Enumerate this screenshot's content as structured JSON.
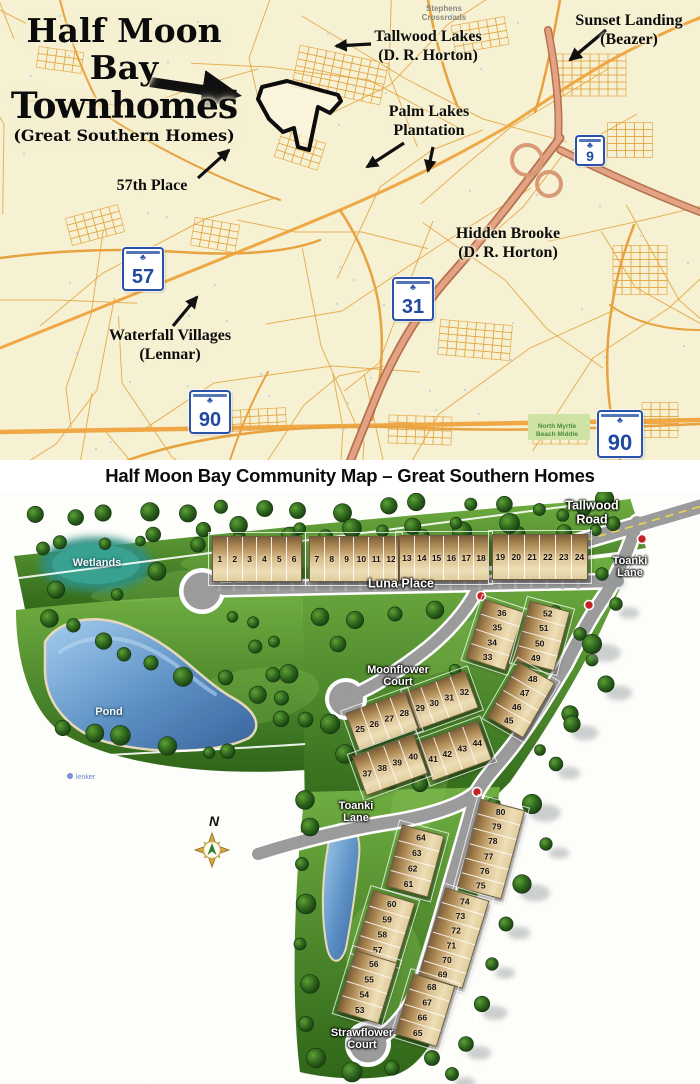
{
  "caption": "Half Moon Bay Community Map – Great Southern Homes",
  "locator_map": {
    "title": {
      "line1": "Half Moon",
      "line2": "Bay",
      "line3": "Townhomes",
      "subtitle": "(Great Southern Homes)"
    },
    "annotations": [
      {
        "name": "stephens-crossroads",
        "style": "tiny",
        "lines": [
          "Stephens",
          "Crossroads"
        ],
        "x": 444,
        "y": 4
      },
      {
        "name": "tallwood-lakes",
        "style": "callout",
        "lines": [
          "Tallwood Lakes",
          "(D. R. Horton)"
        ],
        "x": 428,
        "y": 27
      },
      {
        "name": "sunset-landing",
        "style": "callout",
        "lines": [
          "Sunset Landing",
          "(Beazer)"
        ],
        "x": 629,
        "y": 11
      },
      {
        "name": "palm-lakes-plantation",
        "style": "callout",
        "lines": [
          "Palm Lakes",
          "Plantation"
        ],
        "x": 429,
        "y": 102
      },
      {
        "name": "57th-place",
        "style": "callout",
        "lines": [
          "57th Place"
        ],
        "x": 152,
        "y": 176
      },
      {
        "name": "hidden-brooke",
        "style": "callout",
        "lines": [
          "Hidden Brooke",
          "(D. R. Horton)"
        ],
        "x": 508,
        "y": 224
      },
      {
        "name": "waterfall-villages",
        "style": "callout",
        "lines": [
          "Waterfall Villages",
          "(Lennar)"
        ],
        "x": 170,
        "y": 326
      },
      {
        "name": "north-myrtle-beach-middle-school",
        "style": "tiny-green",
        "lines": [
          "North Myrtle",
          "Beach Middle"
        ],
        "x": 557,
        "y": 423
      }
    ],
    "arrows": [
      {
        "name": "arrow-half-moon-bay",
        "x1": 150,
        "y1": 82,
        "x2": 236,
        "y2": 95,
        "w": 10
      },
      {
        "name": "arrow-tallwood-lakes",
        "x1": 371,
        "y1": 44,
        "x2": 336,
        "y2": 46,
        "w": 3.2
      },
      {
        "name": "arrow-sunset-landing",
        "x1": 606,
        "y1": 30,
        "x2": 570,
        "y2": 60,
        "w": 3.4
      },
      {
        "name": "arrow-palm-lakes-1",
        "x1": 404,
        "y1": 143,
        "x2": 367,
        "y2": 167,
        "w": 3.2
      },
      {
        "name": "arrow-palm-lakes-2",
        "x1": 433,
        "y1": 147,
        "x2": 428,
        "y2": 171,
        "w": 3.2
      },
      {
        "name": "arrow-57th-place",
        "x1": 198,
        "y1": 178,
        "x2": 229,
        "y2": 150,
        "w": 3.2
      },
      {
        "name": "arrow-waterfall-villages",
        "x1": 173,
        "y1": 326,
        "x2": 197,
        "y2": 297,
        "w": 3.2
      }
    ],
    "shields": [
      {
        "number": "9",
        "x": 575,
        "y": 135,
        "size": 26
      },
      {
        "number": "57",
        "x": 122,
        "y": 247,
        "size": 38
      },
      {
        "number": "31",
        "x": 392,
        "y": 277,
        "size": 38
      },
      {
        "number": "90",
        "x": 189,
        "y": 390,
        "size": 38
      },
      {
        "number": "90",
        "x": 597,
        "y": 410,
        "size": 42
      }
    ]
  },
  "site_plan": {
    "street_labels": [
      {
        "name": "tallwood-road",
        "size": "lg",
        "lines": [
          "Tallwood",
          "Road"
        ],
        "x": 592,
        "y": 21
      },
      {
        "name": "toanki-lane-upper",
        "size": "",
        "lines": [
          "Toanki",
          "Lane"
        ],
        "x": 630,
        "y": 75
      },
      {
        "name": "luna-place",
        "size": "lg",
        "lines": [
          "Luna Place"
        ],
        "x": 401,
        "y": 92
      },
      {
        "name": "moonflower-court",
        "size": "",
        "lines": [
          "Moonflower",
          "Court"
        ],
        "x": 398,
        "y": 184
      },
      {
        "name": "toanki-lane-lower",
        "size": "",
        "lines": [
          "Toanki",
          "Lane"
        ],
        "x": 356,
        "y": 320
      },
      {
        "name": "strawflower-court",
        "size": "",
        "lines": [
          "Strawflower",
          "Court"
        ],
        "x": 362,
        "y": 547
      }
    ],
    "area_labels": [
      {
        "name": "wetlands",
        "text": "Wetlands",
        "x": 97,
        "y": 71
      },
      {
        "name": "pond",
        "text": "Pond",
        "x": 109,
        "y": 220
      }
    ],
    "compass_label": "N",
    "watermark": "lenker",
    "buildings": [
      {
        "name": "lots-1-6",
        "type": "row",
        "display": [
          "1",
          "2",
          "3",
          "4",
          "5",
          "6"
        ],
        "cx": 256,
        "cy": 66,
        "w": 88,
        "h": 44,
        "rot": 0,
        "stubs": true
      },
      {
        "name": "lots-7-12",
        "type": "row",
        "display": [
          "7",
          "8",
          "9",
          "10",
          "11",
          "12"
        ],
        "cx": 353,
        "cy": 66,
        "w": 88,
        "h": 44,
        "rot": 0,
        "stubs": true
      },
      {
        "name": "lots-13-18",
        "type": "row",
        "display": [
          "13",
          "14",
          "15",
          "16",
          "17",
          "18"
        ],
        "cx": 443,
        "cy": 65,
        "w": 88,
        "h": 44,
        "rot": 0,
        "stubs": true
      },
      {
        "name": "lots-19-24",
        "type": "row",
        "display": [
          "19",
          "20",
          "21",
          "22",
          "23",
          "24"
        ],
        "cx": 539,
        "cy": 64,
        "w": 94,
        "h": 44,
        "rot": 0,
        "stubs": true
      },
      {
        "name": "lots-33-36",
        "type": "stack",
        "display": [
          "36",
          "35",
          "34",
          "33"
        ],
        "cx": 494,
        "cy": 142,
        "w": 40,
        "h": 60,
        "rot": 18,
        "stubs": false
      },
      {
        "name": "lots-49-52",
        "type": "stack",
        "display": [
          "52",
          "51",
          "50",
          "49"
        ],
        "cx": 541,
        "cy": 143,
        "w": 40,
        "h": 60,
        "rot": 15,
        "stubs": false
      },
      {
        "name": "lots-45-48",
        "type": "stack",
        "display": [
          "48",
          "47",
          "46",
          "45"
        ],
        "cx": 520,
        "cy": 207,
        "w": 40,
        "h": 62,
        "rot": 30,
        "stubs": false
      },
      {
        "name": "lots-29-32",
        "type": "row",
        "display": [
          "29",
          "30",
          "31",
          "32"
        ],
        "cx": 441,
        "cy": 207,
        "w": 62,
        "h": 38,
        "rot": -20,
        "stubs": false
      },
      {
        "name": "lots-25-28",
        "type": "row",
        "display": [
          "25",
          "26",
          "27",
          "28"
        ],
        "cx": 381,
        "cy": 228,
        "w": 62,
        "h": 38,
        "rot": -20,
        "stubs": false
      },
      {
        "name": "lots-41-44",
        "type": "row",
        "display": [
          "41",
          "42",
          "43",
          "44"
        ],
        "cx": 454,
        "cy": 258,
        "w": 62,
        "h": 40,
        "rot": -20,
        "stubs": false
      },
      {
        "name": "lots-37-40",
        "type": "row",
        "display": [
          "37",
          "38",
          "39",
          "40"
        ],
        "cx": 389,
        "cy": 272,
        "w": 64,
        "h": 40,
        "rot": -20,
        "stubs": false
      },
      {
        "name": "lots-61-64",
        "type": "stack",
        "display": [
          "64",
          "63",
          "62",
          "61"
        ],
        "cx": 414,
        "cy": 368,
        "w": 42,
        "h": 62,
        "rot": 15,
        "stubs": false
      },
      {
        "name": "lots-75-80",
        "type": "stack",
        "display": [
          "80",
          "79",
          "78",
          "77",
          "76",
          "75"
        ],
        "cx": 490,
        "cy": 356,
        "w": 44,
        "h": 90,
        "rot": 15,
        "stubs": false
      },
      {
        "name": "lots-69-74",
        "type": "stack",
        "display": [
          "74",
          "73",
          "72",
          "71",
          "70",
          "69"
        ],
        "cx": 453,
        "cy": 445,
        "w": 44,
        "h": 90,
        "rot": 17,
        "stubs": false
      },
      {
        "name": "lots-57-60",
        "type": "stack",
        "display": [
          "60",
          "59",
          "58",
          "57"
        ],
        "cx": 384,
        "cy": 434,
        "w": 42,
        "h": 62,
        "rot": 17,
        "stubs": false
      },
      {
        "name": "lots-53-56",
        "type": "stack",
        "display": [
          "56",
          "55",
          "54",
          "53"
        ],
        "cx": 366,
        "cy": 494,
        "w": 42,
        "h": 62,
        "rot": 17,
        "stubs": false
      },
      {
        "name": "lots-65-68",
        "type": "stack",
        "display": [
          "68",
          "67",
          "66",
          "65"
        ],
        "cx": 424,
        "cy": 517,
        "w": 42,
        "h": 62,
        "rot": 17,
        "stubs": false
      }
    ]
  }
}
